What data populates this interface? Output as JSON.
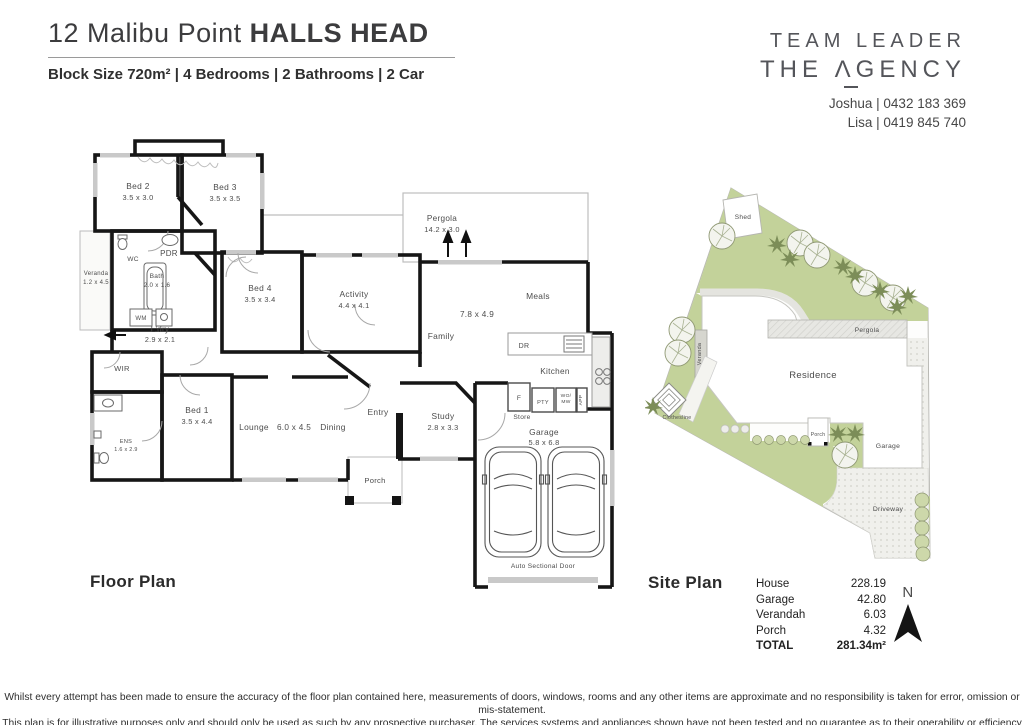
{
  "header": {
    "address": "12 Malibu Point",
    "suburb": "HALLS HEAD",
    "summary": "Block Size 720m² | 4 Bedrooms | 2 Bathrooms | 2 Car"
  },
  "brand": {
    "name_line1": "TEAM LEADER",
    "name_line2": "THE ΛGENCY",
    "contact1": "Joshua | 0432 183 369",
    "contact2": "Lisa | 0419 845 740"
  },
  "floor_plan": {
    "title": "Floor Plan",
    "rooms": {
      "bed2": {
        "name": "Bed 2",
        "dims": "3.5 x 3.0"
      },
      "bed3": {
        "name": "Bed 3",
        "dims": "3.5 x 3.5"
      },
      "bed4": {
        "name": "Bed 4",
        "dims": "3.5 x 3.4"
      },
      "bed1": {
        "name": "Bed 1",
        "dims": "3.5 x 4.4"
      },
      "veranda": {
        "name": "Veranda",
        "dims": "1.2 x 4.5"
      },
      "wc": {
        "name": "WC"
      },
      "pdr": {
        "name": "PDR"
      },
      "bath": {
        "name": "Bath",
        "dims": "2.0 x 1.6"
      },
      "wm": {
        "name": "WM"
      },
      "ldry": {
        "name": "L'dry",
        "dims": "2.9 x 2.1"
      },
      "wir": {
        "name": "WIR"
      },
      "ens": {
        "name": "ENS",
        "dims": "1.6 x 2.9"
      },
      "activity": {
        "name": "Activity",
        "dims": "4.4 x 4.1"
      },
      "pergola": {
        "name": "Pergola",
        "dims": "14.2 x 3.0"
      },
      "meals": {
        "name": "Meals"
      },
      "family": {
        "name": "Family"
      },
      "family_meals_dims": "7.8 x 4.9",
      "kitchen": {
        "name": "Kitchen"
      },
      "dr": {
        "name": "DR"
      },
      "fridge": {
        "name": "F"
      },
      "pantry": {
        "name": "PTY"
      },
      "wall_oven_line1": "WO/",
      "wall_oven_line2": "MW",
      "appliance": {
        "name": "APP"
      },
      "store": {
        "name": "Store"
      },
      "lounge": {
        "name": "Lounge"
      },
      "lounge_dining_dims": "6.0 x 4.5",
      "dining": {
        "name": "Dining"
      },
      "entry": {
        "name": "Entry"
      },
      "study": {
        "name": "Study",
        "dims": "2.8 x 3.3"
      },
      "porch": {
        "name": "Porch"
      },
      "garage": {
        "name": "Garage",
        "dims": "5.8 x 6.8"
      },
      "auto_door": "Auto Sectional Door"
    }
  },
  "site_plan": {
    "title": "Site Plan",
    "labels": {
      "shed": "Shed",
      "pergola": "Pergola",
      "veranda": "Veranda",
      "residence": "Residence",
      "clothesline": "Clothesline",
      "porch": "Porch",
      "garage": "Garage",
      "driveway": "Driveway"
    }
  },
  "areas": {
    "rows": [
      {
        "label": "House",
        "value": "228.19"
      },
      {
        "label": "Garage",
        "value": "42.80"
      },
      {
        "label": "Verandah",
        "value": "6.03"
      },
      {
        "label": "Porch",
        "value": "4.32"
      }
    ],
    "total": {
      "label": "TOTAL",
      "value": "281.34m²"
    }
  },
  "compass": {
    "north": "N"
  },
  "disclaimer": {
    "line1": "Whilst every attempt has been made to ensure the accuracy of the floor plan contained here, measurements of doors, windows, rooms and any other items are approximate and no responsibility is taken for error, omission or mis-statement.",
    "line2": "This plan is for illustrative purposes only and should only be used as such by any prospective purchaser. The services systems and appliances shown have not been tested and no guarantee as to their operability or efficiency can be given."
  }
}
